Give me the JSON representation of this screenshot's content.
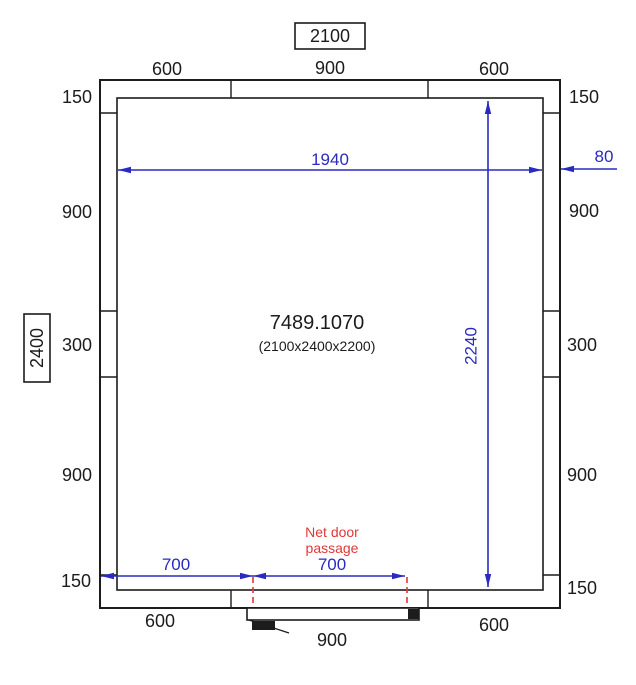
{
  "colors": {
    "line": "#1c1c1c",
    "dimension_blue": "#2a2ac0",
    "alert_red": "#e03838"
  },
  "plan": {
    "product_code": "7489.1070",
    "overall_dimensions": "(2100x2400x2200)",
    "overall_width_label": "2100",
    "overall_depth_label": "2400",
    "inner_width": "1940",
    "inner_height": "2240",
    "wall_clearance": "80",
    "door": {
      "note_line1": "Net door",
      "note_line2": "passage",
      "offset_left": "700",
      "passage_width": "700",
      "leaf_width_label": "900"
    },
    "panels": {
      "top": [
        "600",
        "900",
        "600"
      ],
      "bottom_left": "600",
      "bottom_right": "600",
      "left": [
        "150",
        "900",
        "300",
        "900",
        "150"
      ],
      "right": [
        "150",
        "900",
        "300",
        "900",
        "150"
      ]
    }
  }
}
